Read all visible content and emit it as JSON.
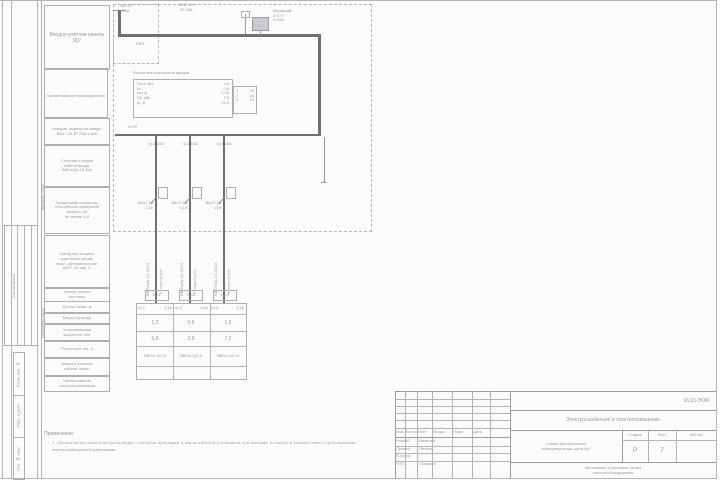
{
  "frame": {
    "soglasovano": "Согласовано",
    "vzam": "Взам. инв. №",
    "podp": "Подп. и дата",
    "inv": "Инв. № подл."
  },
  "left_panel": {
    "rows": [
      "Вводно-учетная панель\nЩУ",
      "Наименование присоединения",
      "Аппарат защиты на вводе:\nВА47-29 3Р 25А 4,5кА",
      "Сечение и марка\nкабеля ввода:\nВВГнг(А)-LS 5х6",
      "Предельная коммутац.\nспособность аппаратов\nзащиты, кА\nне менее 4,5",
      "Аппараты защиты\nгрупповых линий:\nвыкл. автоматические\nВА47-29 хар. С",
      "Номер группы\nпо плану",
      "Длина линии, м",
      "Марка провода",
      "Установленная\nмощность, кВт",
      "Расчетный ток, А",
      "Марка и сечение\nкабеля линии",
      "Наименование\nэлектроприемников"
    ],
    "side_top": "вводная часть",
    "side_bottom": "групповая часть"
  },
  "schematic": {
    "input_label": "ВН-32\n25А",
    "main_breaker_label": "ВА47-29\n3Р 25А",
    "meter_label": "Меркурий\n201.5\n5-60А",
    "pen_label": "PEN",
    "npe_label": "N PE",
    "calc_title": "Расчетные показатели вводов:",
    "calc_rows": [
      [
        "Руст, кВт",
        "3,5"
      ],
      [
        "Кс",
        "0,8"
      ],
      [
        "cos φ",
        "0,95"
      ],
      [
        "Рр, кВт",
        "2,8"
      ],
      [
        "Iр, А",
        "13,4"
      ]
    ],
    "side_rows": [
      [
        "1",
        "25"
      ],
      [
        "2",
        "16"
      ],
      [
        "3",
        "10"
      ]
    ]
  },
  "feeders": [
    {
      "id": "гр.1",
      "rating": "С16",
      "top_label": "гр.1 16А",
      "breaker": "ВА47-29\nС16",
      "cable": "ВВГнг(А)-LS 3х2,5",
      "duct": "в гофротрубе",
      "box": "Гр.1",
      "p": "1,2",
      "i": "5,8",
      "line": "ВВГнг 3х2,5"
    },
    {
      "id": "гр.2",
      "rating": "С16",
      "top_label": "гр.2 16А",
      "breaker": "ВА47-29\nС16",
      "cable": "ВВГнг(А)-LS 3х2,5",
      "duct": "в гофротрубе",
      "box": "Гр.2",
      "p": "0,8",
      "i": "3,9",
      "line": "ВВГнг 3х2,5"
    },
    {
      "id": "гр.3",
      "rating": "С16",
      "top_label": "гр.3 16А",
      "breaker": "ВА47-29\nС16",
      "cable": "ВВГнг(А)-LS 3х2,5",
      "duct": "в гофротрубе",
      "box": "Гр.3",
      "p": "1,5",
      "i": "7,2",
      "line": "ВВГнг 3х2,5"
    }
  ],
  "notes": {
    "title": "Примечание:",
    "line1": "1. Обозначения типов электропроводок, способов прокладки и марок кабелей уточняются при монтаже по месту в соответствии с требованиями",
    "line2": "электроснабжающей организации."
  },
  "titleblock": {
    "doc_small": "16.13-ЭОМ",
    "designation": "Электроснабжение и электроосвещение",
    "cols": [
      "Изм.",
      "Кол.уч.",
      "Лист",
      "№ док.",
      "Подп.",
      "Дата"
    ],
    "rows": [
      {
        "role": "Разраб.",
        "name": "Иванова"
      },
      {
        "role": "Провер.",
        "name": "Петров"
      },
      {
        "role": "Н.контр.",
        "name": ""
      },
      {
        "role": "ГИП",
        "name": "Смирнов"
      }
    ],
    "title": "Схема электрическая\nпринципиальная щита ЩУ",
    "stage_cols": [
      "Стадия",
      "Лист",
      "Листов"
    ],
    "stage_vals": [
      "Р",
      "7",
      ""
    ],
    "org": "Монтажные и пусковые схемы\nэлектрооборудования"
  }
}
